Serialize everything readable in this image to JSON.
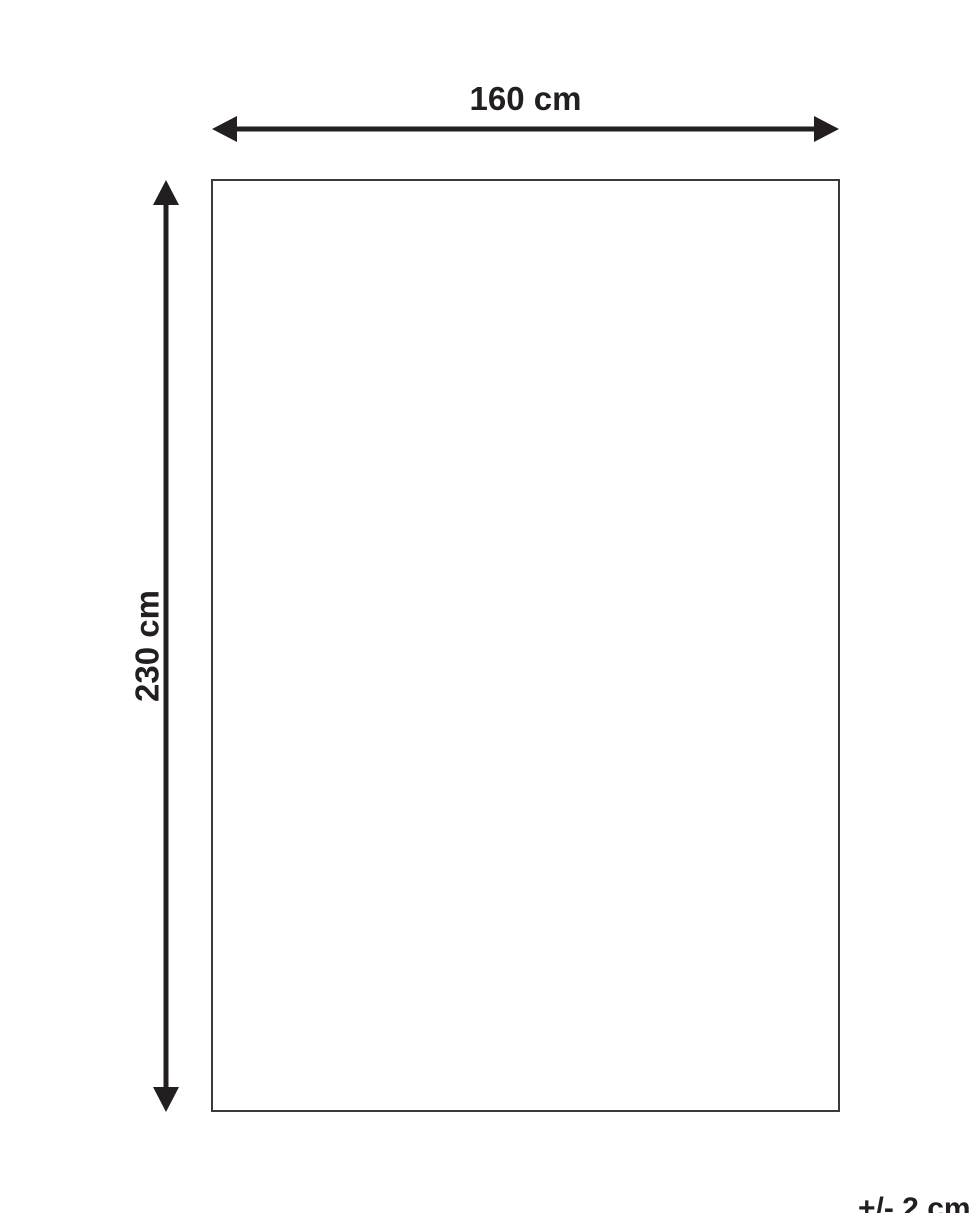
{
  "diagram": {
    "title": "product-dimension-diagram",
    "width_label": "160 cm",
    "height_label": "230 cm",
    "tolerance_label": "+/- 2 cm",
    "width_value_cm": 160,
    "height_value_cm": 230,
    "tolerance_value_cm": 2
  },
  "colors": {
    "arrow": "#231f20",
    "text": "#231f20",
    "rect_border": "#3a3a3a",
    "background": "#ffffff"
  }
}
